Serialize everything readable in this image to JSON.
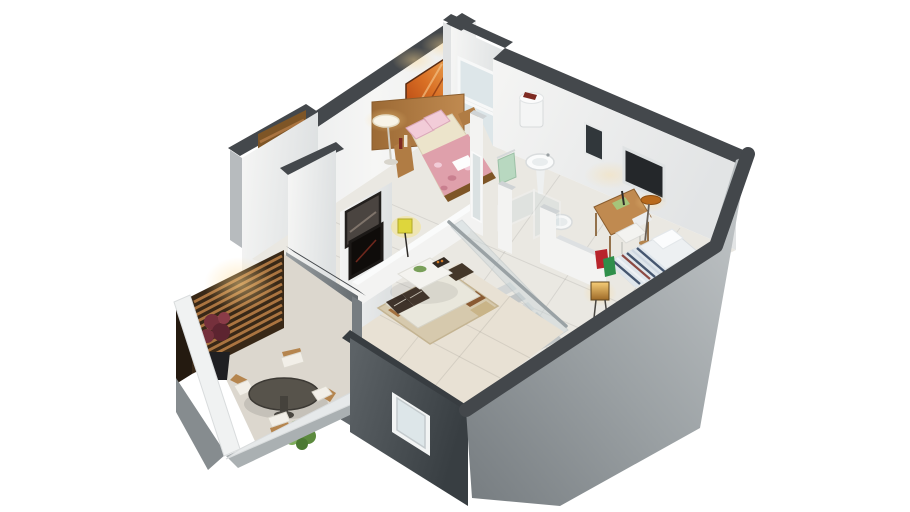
{
  "meta": {
    "title": "3D isometric cutaway floor-plan render of a small two-level apartment",
    "background": "#ffffff",
    "canvas_width": 910,
    "canvas_height": 512
  },
  "palette": {
    "bg": "#ffffff",
    "wall-cap": "#44484c",
    "wall-cap-dark": "#383d41",
    "wall-white": "#f3f3f2",
    "wall-white-shade": "#e0e2e3",
    "wall-gray-light": "#b7bbbe",
    "wall-gray": "#878d90",
    "wall-gray-dark": "#4c5256",
    "floor-tile": "#eae8e2",
    "floor-warm": "#e8e1d4",
    "balcony-floor": "#dcd7ce",
    "wood": "#b07c44",
    "wood-dark": "#7e5526",
    "slat-wood": "#aa7440",
    "slat-bg": "#382817",
    "glass": "#cdd8db",
    "glass-blue": "#dde6e9",
    "art-orange-1": "#c85a1e",
    "art-orange-2": "#e89a4e",
    "bed-cream": "#ece4cb",
    "duvet-pink": "#dfa0ab",
    "pillow-pink": "#f2ccd8",
    "stripe-navy": "#45566f",
    "stripe-red": "#8d4a43",
    "sofa-cream": "#e9e7dc",
    "cushion-brown": "#3f332a",
    "rug-beige": "#d6c9ad",
    "rug-brown": "#a3713f",
    "plant-green": "#6b9a4c",
    "plant-red": "#75303c",
    "towel-green": "#b8d8c0",
    "bag-red": "#b8242c",
    "bag-green": "#2f8f4a",
    "lamp-warm": "#f7c97e",
    "lamp-orange": "#b96a1c",
    "lamp-yellow": "#ded63c",
    "table-dark": "#57534b",
    "chair-wood": "#b5854e"
  },
  "scene": {
    "type": "isometric-3d-floor-plan-render",
    "view": "cutaway dollhouse view from a raised south-east camera angle",
    "levels": "upper floor shown; double-height living room and staircase down to lower level",
    "rooms": [
      {
        "name": "master-bedroom",
        "position": "top-left",
        "items": [
          "double-bed-pink-floral-duvet",
          "wood-headboard-panel",
          "bedside-unit-with-bottles",
          "white-floor-lamp",
          "orange-abstract-wall-art",
          "tall-white-window"
        ]
      },
      {
        "name": "bathroom",
        "position": "top-center",
        "items": [
          "water-heater",
          "pedestal-sink",
          "toilet",
          "green-towels-on-rail",
          "glass-shower-enclosure"
        ]
      },
      {
        "name": "study-corner",
        "position": "right",
        "items": [
          "wood-desk",
          "white-chair",
          "orange-shade-floor-lamp",
          "dark-glazed-window"
        ]
      },
      {
        "name": "second-bedroom",
        "position": "right",
        "items": [
          "single-bed-navy-striped-duvet",
          "white-pillow",
          "glowing-cube-lamp",
          "red-bag",
          "green-bag"
        ]
      },
      {
        "name": "hallway-stairwell",
        "position": "center",
        "items": [
          "glass-stair-balustrade",
          "descending-staircase",
          "white-partition-walls"
        ]
      },
      {
        "name": "living-room",
        "position": "center-left-double-height",
        "items": [
          "cream-sofa-dark-cushions",
          "white-coffee-table",
          "green-bowl",
          "dark-serving-tray",
          "area-rug-with-brown-blocks",
          "wall-tv",
          "framed-landscape-picture",
          "yellow-floor-lamp"
        ]
      },
      {
        "name": "balcony",
        "position": "bottom-left",
        "items": [
          "wood-slat-privacy-screen",
          "warm-accent-lighting",
          "red-potted-plant",
          "round-outdoor-table",
          "four-wood-chairs-white-cushions",
          "green-bush",
          "white-parapet-railing"
        ]
      }
    ],
    "exterior": [
      "dark-gray-wall-caps",
      "gray-concrete-cut-walls",
      "small-window-in-bottom-wall",
      "white-paneled-door-to-balcony"
    ]
  }
}
